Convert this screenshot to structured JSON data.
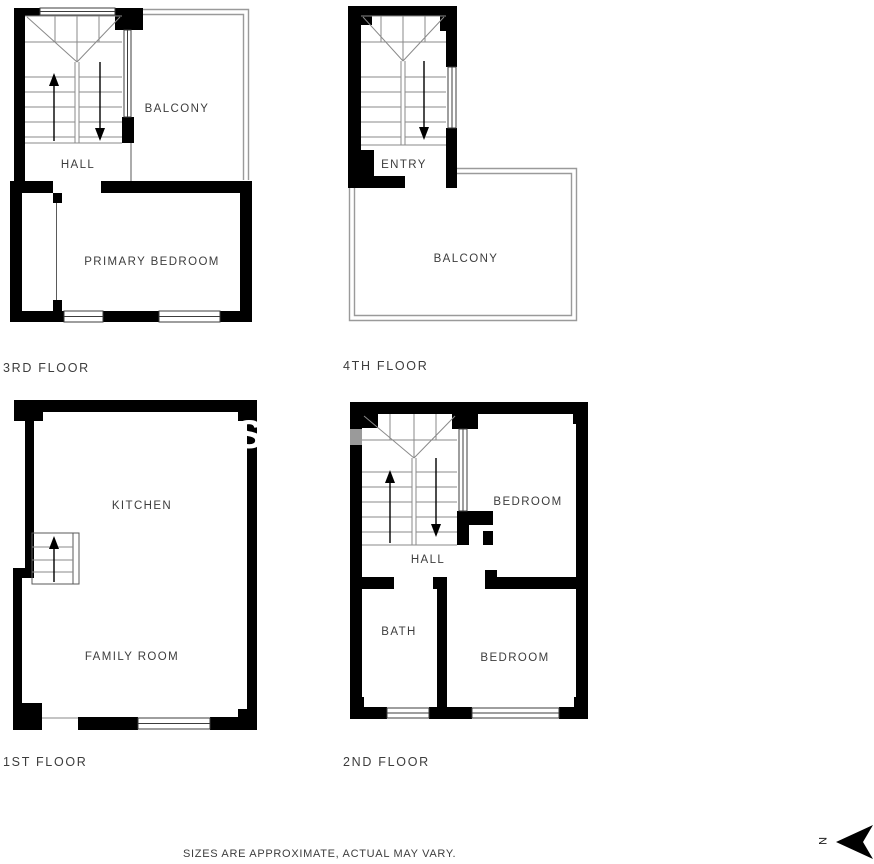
{
  "colors": {
    "wall": "#000000",
    "thin_line": "#8a8a8a",
    "window_stroke": "#3c3c3c",
    "text": "#3d3d3d",
    "background": "#ffffff"
  },
  "floor_3rd": {
    "title": "3RD FLOOR",
    "hall_label": "HALL",
    "balcony_label": "BALCONY",
    "bedroom_label": "PRIMARY BEDROOM"
  },
  "floor_4th": {
    "title": "4TH FLOOR",
    "entry_label": "ENTRY",
    "balcony_label": "BALCONY"
  },
  "floor_1st": {
    "title": "1ST FLOOR",
    "kitchen_label": "KITCHEN",
    "family_room_label": "FAMILY ROOM"
  },
  "floor_2nd": {
    "title": "2ND FLOOR",
    "hall_label": "HALL",
    "bedroom_upper_label": "BEDROOM",
    "bath_label": "BATH",
    "bedroom_lower_label": "BEDROOM"
  },
  "footer": {
    "disclaimer": "SIZES ARE APPROXIMATE, ACTUAL MAY VARY.",
    "compass_label": "N"
  },
  "watermark": {
    "fragment": "S"
  }
}
